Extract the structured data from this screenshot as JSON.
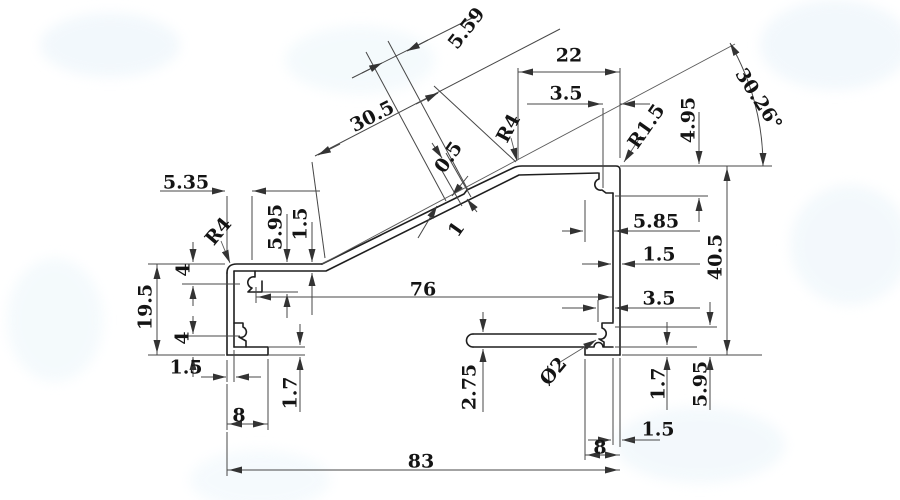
{
  "drawing": {
    "type": "technical-cross-section",
    "subject": "aluminum-profile-section-with-dimensions",
    "units": "mm",
    "colors": {
      "background": "#ffffff",
      "profile_line": "#1e1e1e",
      "dimension_line": "#474747",
      "text": "#141414",
      "watermark": "#e8f3fa"
    },
    "labels": [
      {
        "id": "dim-5-59",
        "text": "5.59",
        "x": 466,
        "y": 28,
        "rot": -52
      },
      {
        "id": "dim-30-5",
        "text": "30.5",
        "x": 372,
        "y": 116,
        "rot": -27
      },
      {
        "id": "dim-0-5",
        "text": "0.5",
        "x": 448,
        "y": 157,
        "rot": -55
      },
      {
        "id": "dim-1",
        "text": "1",
        "x": 456,
        "y": 229,
        "rot": -55
      },
      {
        "id": "dim-r4-slope",
        "text": "R4",
        "x": 508,
        "y": 128,
        "rot": -62
      },
      {
        "id": "dim-22",
        "text": "22",
        "x": 569,
        "y": 55,
        "rot": 0
      },
      {
        "id": "dim-3-5-top",
        "text": "3.5",
        "x": 566,
        "y": 93,
        "rot": 0
      },
      {
        "id": "dim-r1-5",
        "text": "R1.5",
        "x": 646,
        "y": 126,
        "rot": -55
      },
      {
        "id": "dim-30-26",
        "text": "30.26°",
        "x": 759,
        "y": 99,
        "rot": 57
      },
      {
        "id": "dim-4-95",
        "text": "4.95",
        "x": 688,
        "y": 120,
        "rot": -90
      },
      {
        "id": "dim-5-35",
        "text": "5.35",
        "x": 186,
        "y": 182,
        "rot": 0
      },
      {
        "id": "dim-5-95-l",
        "text": "5.95",
        "x": 275,
        "y": 227,
        "rot": -90
      },
      {
        "id": "dim-1-5-l",
        "text": "1.5",
        "x": 300,
        "y": 224,
        "rot": -90
      },
      {
        "id": "dim-r4-left",
        "text": "R4",
        "x": 218,
        "y": 231,
        "rot": -50
      },
      {
        "id": "dim-4-upper",
        "text": "4",
        "x": 183,
        "y": 270,
        "rot": -90
      },
      {
        "id": "dim-19-5",
        "text": "19.5",
        "x": 145,
        "y": 307,
        "rot": -90
      },
      {
        "id": "dim-4-lower",
        "text": "4",
        "x": 182,
        "y": 338,
        "rot": -90
      },
      {
        "id": "dim-1-5-bl",
        "text": "1.5",
        "x": 186,
        "y": 367,
        "rot": 0
      },
      {
        "id": "dim-1-7-l",
        "text": "1.7",
        "x": 290,
        "y": 393,
        "rot": -90
      },
      {
        "id": "dim-8-bl",
        "text": "8",
        "x": 239,
        "y": 415,
        "rot": 0
      },
      {
        "id": "dim-76",
        "text": "76",
        "x": 423,
        "y": 289,
        "rot": 0
      },
      {
        "id": "dim-2-75",
        "text": "2.75",
        "x": 469,
        "y": 387,
        "rot": -90
      },
      {
        "id": "dim-phi2",
        "text": "Ø2",
        "x": 553,
        "y": 371,
        "rot": -50
      },
      {
        "id": "dim-5-85",
        "text": "5.85",
        "x": 656,
        "y": 221,
        "rot": 0
      },
      {
        "id": "dim-1-5-r",
        "text": "1.5",
        "x": 659,
        "y": 254,
        "rot": 0
      },
      {
        "id": "dim-3-5-r",
        "text": "3.5",
        "x": 659,
        "y": 298,
        "rot": 0
      },
      {
        "id": "dim-40-5",
        "text": "40.5",
        "x": 715,
        "y": 257,
        "rot": -90
      },
      {
        "id": "dim-1-7-r",
        "text": "1.7",
        "x": 658,
        "y": 384,
        "rot": -90
      },
      {
        "id": "dim-5-95-r",
        "text": "5.95",
        "x": 700,
        "y": 384,
        "rot": -90
      },
      {
        "id": "dim-1-5-br",
        "text": "1.5",
        "x": 658,
        "y": 429,
        "rot": 0
      },
      {
        "id": "dim-8-br",
        "text": "8",
        "x": 600,
        "y": 447,
        "rot": 0
      },
      {
        "id": "dim-83",
        "text": "83",
        "x": 421,
        "y": 461,
        "rot": 0
      }
    ]
  }
}
